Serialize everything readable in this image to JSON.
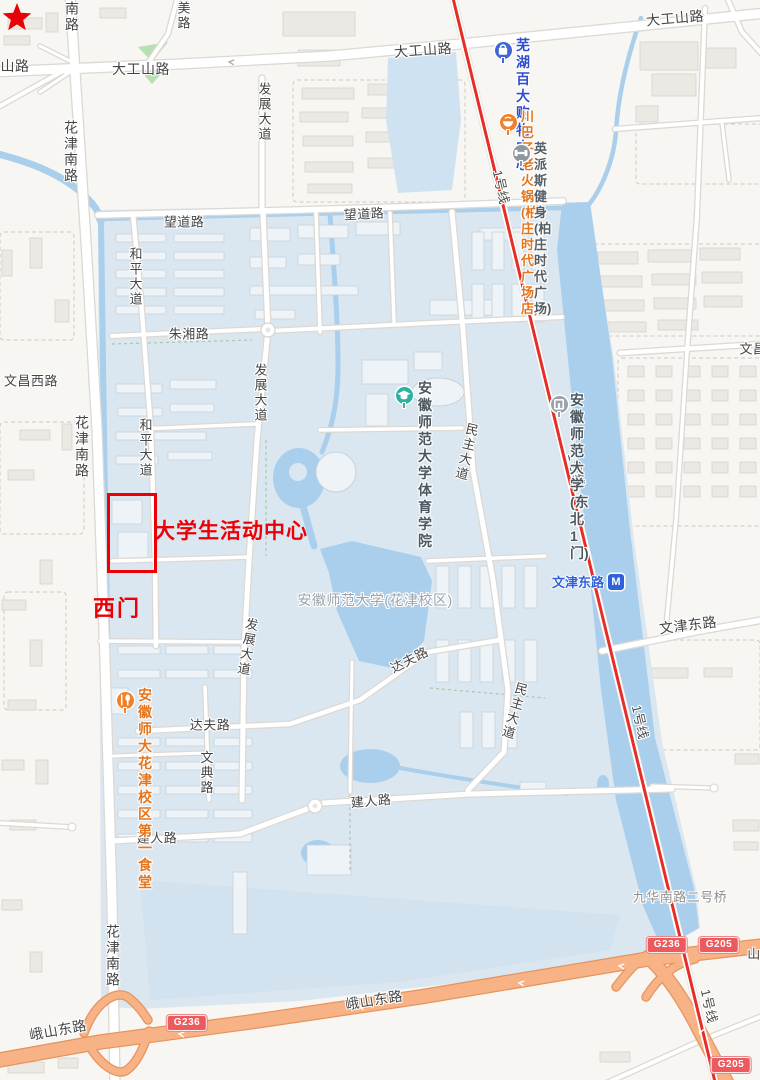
{
  "annotations": {
    "highlight_label": "大学生活动中心",
    "gate_label": "西门"
  },
  "metro_station": {
    "name": "文津东路",
    "logo": "M"
  },
  "metro_line": {
    "label": "1号线",
    "color": "#e62e28"
  },
  "colors": {
    "campus_area": "#dbe7f0",
    "water": "#a9cfec",
    "highway": "#f7b285",
    "shield_red": "#ed5a5e",
    "annotation_red": "#ea0006",
    "poi_orange": "#f0812a",
    "poi_blue": "#3f66d4",
    "poi_teal": "#2db3a2",
    "poi_gray": "#9aa2a8"
  },
  "road_labels": [
    {
      "t": "南路",
      "x": 72,
      "y": 17,
      "s": 14,
      "v": true
    },
    {
      "t": "美路",
      "x": 183,
      "y": 16,
      "s": 13,
      "v": true
    },
    {
      "t": "山路",
      "x": 15,
      "y": 66,
      "s": 14
    },
    {
      "t": "大工山路",
      "x": 141,
      "y": 69,
      "s": 14
    },
    {
      "t": "大工山路",
      "x": 423,
      "y": 50,
      "s": 14,
      "r": -4
    },
    {
      "t": "大工山路",
      "x": 675,
      "y": 18,
      "s": 14,
      "r": -5
    },
    {
      "t": "花津南路",
      "x": 71,
      "y": 152,
      "s": 14,
      "v": true
    },
    {
      "t": "望道路",
      "x": 184,
      "y": 221,
      "s": 13
    },
    {
      "t": "望道路",
      "x": 364,
      "y": 213,
      "s": 13,
      "r": -3
    },
    {
      "t": "和平大道",
      "x": 135,
      "y": 277,
      "s": 13,
      "v": true
    },
    {
      "t": "朱湘路",
      "x": 189,
      "y": 333,
      "s": 13
    },
    {
      "t": "发展大道",
      "x": 264,
      "y": 112,
      "s": 13,
      "v": true
    },
    {
      "t": "发展大道",
      "x": 260,
      "y": 393,
      "s": 13,
      "v": true
    },
    {
      "t": "发展大道",
      "x": 247,
      "y": 647,
      "s": 13,
      "v": true,
      "r": 10
    },
    {
      "t": "文昌西路",
      "x": 31,
      "y": 380,
      "s": 13
    },
    {
      "t": "花津南路",
      "x": 82,
      "y": 447,
      "s": 14,
      "v": true
    },
    {
      "t": "和平大道",
      "x": 145,
      "y": 448,
      "s": 13,
      "v": true
    },
    {
      "t": "民主大道",
      "x": 466,
      "y": 452,
      "s": 13,
      "v": true,
      "r": 13
    },
    {
      "t": "民主大道",
      "x": 514,
      "y": 711,
      "s": 13,
      "v": true,
      "r": 16
    },
    {
      "t": "达夫路",
      "x": 409,
      "y": 659,
      "s": 13,
      "r": -27
    },
    {
      "t": "达夫路",
      "x": 210,
      "y": 724,
      "s": 13
    },
    {
      "t": "文典路",
      "x": 206,
      "y": 773,
      "s": 13,
      "v": true
    },
    {
      "t": "建人路",
      "x": 157,
      "y": 837,
      "s": 13
    },
    {
      "t": "建人路",
      "x": 371,
      "y": 800,
      "s": 13,
      "r": -5
    },
    {
      "t": "花津南路",
      "x": 113,
      "y": 956,
      "s": 14,
      "v": true
    },
    {
      "t": "峨山东路",
      "x": 58,
      "y": 1030,
      "s": 14,
      "r": -10
    },
    {
      "t": "峨山东路",
      "x": 374,
      "y": 1000,
      "s": 14,
      "r": -9
    },
    {
      "t": "文津东路",
      "x": 688,
      "y": 625,
      "s": 14,
      "r": -7
    },
    {
      "t": "文昌",
      "x": 753,
      "y": 348,
      "s": 13
    },
    {
      "t": "山",
      "x": 754,
      "y": 953,
      "s": 13
    },
    {
      "t": "九华南路二号桥",
      "x": 680,
      "y": 896,
      "s": 13,
      "c": "#8f8f8f"
    },
    {
      "t": "1号线",
      "x": 502,
      "y": 187,
      "s": 13,
      "r": 77,
      "c": "#4c4c4c",
      "k": "metro"
    },
    {
      "t": "1号线",
      "x": 577,
      "y": 470,
      "s": 13,
      "r": 77,
      "c": "#4c4c4c",
      "k": "metro"
    },
    {
      "t": "1号线",
      "x": 641,
      "y": 722,
      "s": 13,
      "r": 77,
      "c": "#4c4c4c",
      "k": "metro"
    },
    {
      "t": "1号线",
      "x": 710,
      "y": 1006,
      "s": 13,
      "r": 77,
      "c": "#4c4c4c",
      "k": "metro"
    },
    {
      "t": "安徽师范大学(花津校区)",
      "x": 375,
      "y": 600,
      "s": 14,
      "c": "#9aa2ab",
      "k": "area"
    }
  ],
  "pois": [
    {
      "id": "wuhu-baida-mall",
      "lines": [
        "芜湖百大",
        "购物中心"
      ],
      "ix": 503,
      "iy": 50,
      "icon": "bag",
      "ic": "#3f66d4",
      "tc": "#2e4ecb",
      "tx": 516,
      "ty": 37,
      "s": 14
    },
    {
      "id": "chuanbazi-hotpot",
      "lines": [
        "川巴子老火锅(柏",
        "庄时代广场店)"
      ],
      "ix": 508,
      "iy": 122,
      "icon": "pot",
      "ic": "#f0812a",
      "tc": "#e4751c",
      "tx": 521,
      "ty": 109,
      "s": 13
    },
    {
      "id": "yingpaisi-gym",
      "lines": [
        "英派斯健身(柏",
        "庄时代广场)"
      ],
      "ix": 521,
      "iy": 153,
      "icon": "dumbbell",
      "ic": "#8e979d",
      "tc": "#555f66",
      "tx": 534,
      "ty": 141,
      "s": 13
    },
    {
      "id": "ahnu-sports-college",
      "lines": [
        "安徽师范大",
        "学体育学院"
      ],
      "ix": 404,
      "iy": 395,
      "icon": "cap",
      "ic": "#2db3a2",
      "tc": "#4b5860",
      "tx": 418,
      "ty": 380,
      "s": 14
    },
    {
      "id": "ahnu-northeast-gate1",
      "lines": [
        "安徽师范大",
        "学(东北1门)"
      ],
      "ix": 559,
      "iy": 404,
      "icon": "gate",
      "ic": "#9aa2a8",
      "tc": "#4b5860",
      "tx": 570,
      "ty": 392,
      "s": 14
    },
    {
      "id": "ahnu-canteen1",
      "lines": [
        "安徽师大花津",
        "校区第一食堂"
      ],
      "ix": 125,
      "iy": 700,
      "icon": "food",
      "ic": "#f0812a",
      "tc": "#e4751c",
      "tx": 138,
      "ty": 687,
      "s": 14
    }
  ],
  "shields": [
    {
      "code": "G236",
      "x": 187,
      "y": 1023
    },
    {
      "code": "G236",
      "x": 667,
      "y": 945
    },
    {
      "code": "G205",
      "x": 719,
      "y": 945
    },
    {
      "code": "G205",
      "x": 731,
      "y": 1065
    }
  ]
}
